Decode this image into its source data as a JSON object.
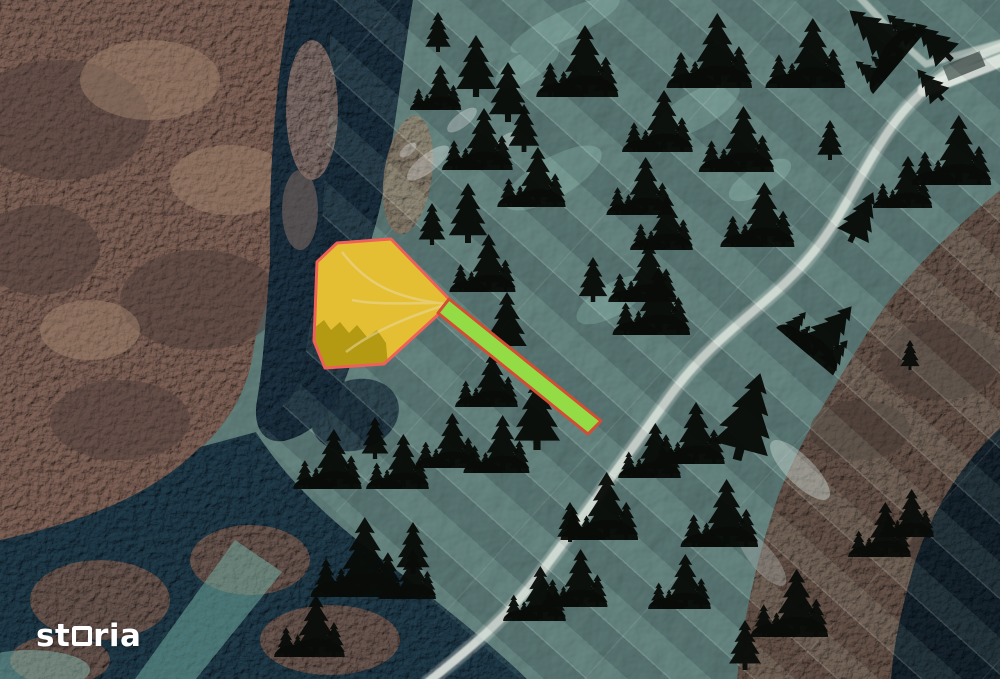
{
  "watermark": {
    "brand": "storia",
    "brand_pre": "st",
    "brand_post": "ria"
  },
  "map": {
    "colors": {
      "tree": "#080b08",
      "parcel_meadow": "#c8ab68",
      "parcel_fill": "#ffd400",
      "parcel_fill_opacity": 0.5,
      "parcel_stroke": "#ef6058",
      "strip_fill": "#93dc45",
      "strip_stroke": "#d24d33"
    },
    "parcel_points": "337,243 391,239 449,299 441,312 384,364 325,368 314,341 317,262",
    "access_strip_points": "449,299 601,421 588,434 438,313",
    "tree_markers": [
      [
        476,
        97,
        62,
        "s",
        0
      ],
      [
        436,
        110,
        45,
        "g",
        0
      ],
      [
        508,
        122,
        60,
        "s",
        0
      ],
      [
        478,
        170,
        62,
        "g",
        0
      ],
      [
        524,
        152,
        48,
        "s",
        0
      ],
      [
        578,
        97,
        72,
        "g",
        0
      ],
      [
        658,
        152,
        62,
        "g",
        0
      ],
      [
        710,
        88,
        75,
        "g",
        0
      ],
      [
        806,
        88,
        70,
        "g",
        0
      ],
      [
        900,
        62,
        72,
        "g",
        -50
      ],
      [
        952,
        60,
        52,
        "s",
        -45
      ],
      [
        943,
        100,
        40,
        "s",
        -40
      ],
      [
        640,
        215,
        58,
        "g",
        0
      ],
      [
        662,
        250,
        55,
        "g",
        0
      ],
      [
        758,
        247,
        65,
        "g",
        0
      ],
      [
        850,
        242,
        55,
        "s",
        25
      ],
      [
        952,
        185,
        70,
        "g",
        0
      ],
      [
        903,
        208,
        52,
        "g",
        0
      ],
      [
        532,
        207,
        60,
        "g",
        0
      ],
      [
        468,
        243,
        60,
        "s",
        0
      ],
      [
        432,
        245,
        42,
        "s",
        0
      ],
      [
        483,
        292,
        58,
        "g",
        0
      ],
      [
        643,
        302,
        60,
        "g",
        0
      ],
      [
        593,
        302,
        45,
        "s",
        0
      ],
      [
        507,
        354,
        62,
        "s",
        0
      ],
      [
        652,
        335,
        68,
        "g",
        0
      ],
      [
        805,
        352,
        65,
        "g",
        40
      ],
      [
        737,
        460,
        90,
        "s",
        15
      ],
      [
        690,
        464,
        62,
        "g",
        0
      ],
      [
        910,
        370,
        30,
        "s",
        0
      ],
      [
        487,
        407,
        55,
        "g",
        0
      ],
      [
        537,
        450,
        72,
        "s",
        0
      ],
      [
        328,
        489,
        60,
        "g",
        0
      ],
      [
        375,
        459,
        42,
        "s",
        0
      ],
      [
        398,
        489,
        55,
        "g",
        0
      ],
      [
        447,
        468,
        55,
        "g",
        0
      ],
      [
        497,
        473,
        58,
        "g",
        0
      ],
      [
        357,
        597,
        80,
        "g",
        0
      ],
      [
        408,
        599,
        50,
        "g",
        0
      ],
      [
        413,
        574,
        52,
        "s",
        0
      ],
      [
        310,
        657,
        62,
        "g",
        0
      ],
      [
        535,
        621,
        55,
        "g",
        0
      ],
      [
        570,
        542,
        40,
        "s",
        0
      ],
      [
        600,
        540,
        68,
        "g",
        0
      ],
      [
        650,
        478,
        55,
        "g",
        0
      ],
      [
        720,
        547,
        68,
        "g",
        0
      ],
      [
        575,
        607,
        58,
        "g",
        0
      ],
      [
        680,
        609,
        55,
        "g",
        0
      ],
      [
        790,
        637,
        68,
        "g",
        0
      ],
      [
        880,
        557,
        55,
        "g",
        0
      ],
      [
        907,
        537,
        48,
        "g",
        0
      ],
      [
        745,
        670,
        50,
        "s",
        0
      ],
      [
        830,
        160,
        40,
        "s",
        0
      ],
      [
        438,
        52,
        40,
        "s",
        0
      ],
      [
        737,
        172,
        66,
        "g",
        0
      ]
    ]
  }
}
